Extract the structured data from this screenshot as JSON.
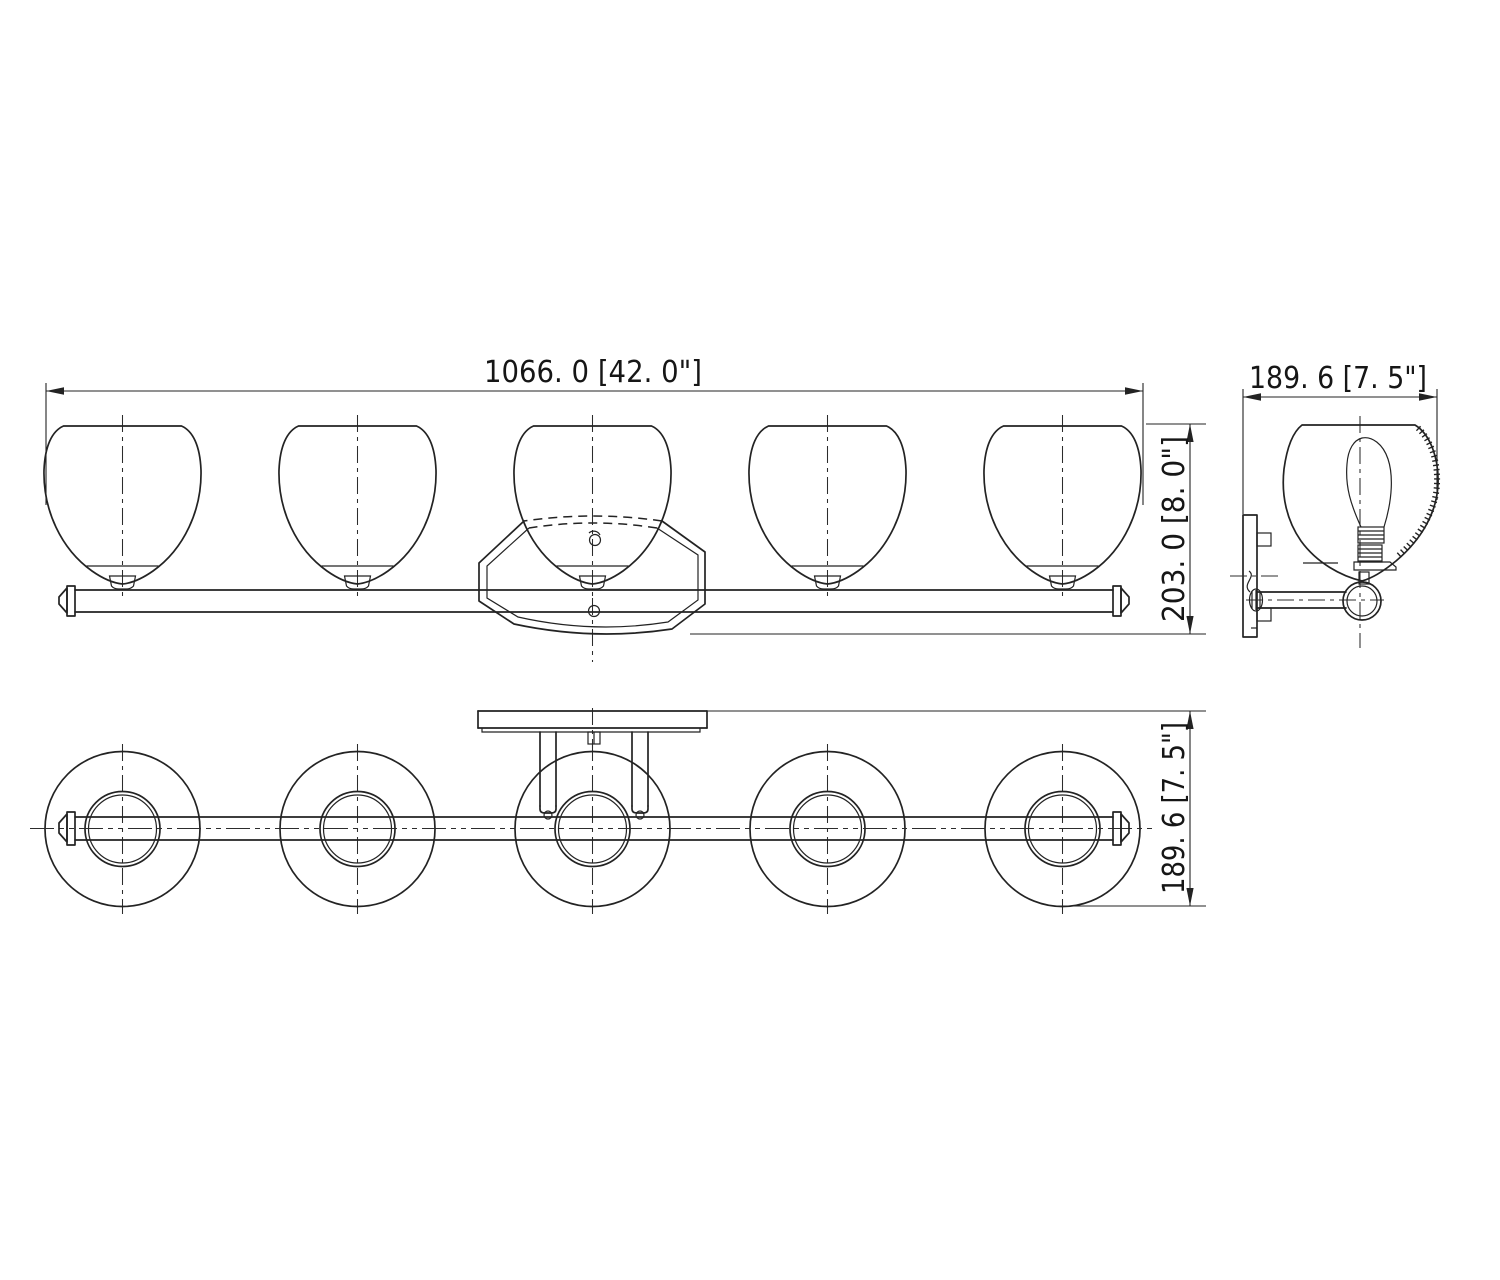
{
  "drawing": {
    "description": "three-view dimension drawing of a five-light vanity bar fixture",
    "colors": {
      "line": "#232323",
      "background": "#ffffff"
    },
    "dimensions": {
      "front_width": "1066. 0  [42. 0\"]",
      "front_height": "203. 0  [8. 0\"]",
      "side_depth": "189. 6  [7. 5\"]",
      "plan_depth": "189. 6  [7. 5\"]"
    }
  }
}
